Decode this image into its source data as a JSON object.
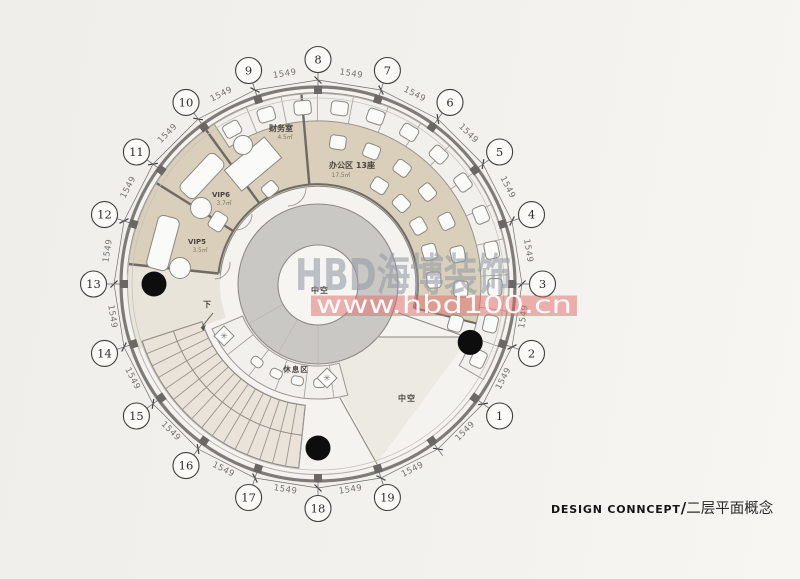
{
  "page": {
    "background": "#f3f1ed"
  },
  "watermark": {
    "brand": "HBD海博装饰",
    "url": "www.hbd100.cn",
    "brand_color": "#949ba6",
    "band_color": "#df6a6a",
    "url_color": "#ffffff"
  },
  "caption": {
    "en": "DESIGN CONNCEPT",
    "divider": "/",
    "cn": "二层平面概念"
  },
  "grid": {
    "dim_label": "1549",
    "bubbles": [
      {
        "n": "1",
        "angle": 324
      },
      {
        "n": "2",
        "angle": 342
      },
      {
        "n": "3",
        "angle": 0
      },
      {
        "n": "4",
        "angle": 18
      },
      {
        "n": "5",
        "angle": 36
      },
      {
        "n": "6",
        "angle": 54
      },
      {
        "n": "7",
        "angle": 72
      },
      {
        "n": "8",
        "angle": 90
      },
      {
        "n": "9",
        "angle": 108
      },
      {
        "n": "10",
        "angle": 126
      },
      {
        "n": "11",
        "angle": 144
      },
      {
        "n": "12",
        "angle": 162
      },
      {
        "n": "13",
        "angle": 180
      },
      {
        "n": "14",
        "angle": 198
      },
      {
        "n": "15",
        "angle": 216
      },
      {
        "n": "16",
        "angle": 234
      },
      {
        "n": "17",
        "angle": 252
      },
      {
        "n": "18",
        "angle": 270
      },
      {
        "n": "19",
        "angle": 288
      }
    ]
  },
  "rooms": [
    {
      "label": "财务室",
      "area": "4.5㎡"
    },
    {
      "label": "办公区  13座",
      "area": "17.5㎡"
    },
    {
      "label": "VIP6",
      "area": "3.7㎡"
    },
    {
      "label": "VIP5",
      "area": "3.5㎡"
    },
    {
      "label": "休息区"
    },
    {
      "label": "中空"
    },
    {
      "label": "中空"
    },
    {
      "label": "下"
    }
  ],
  "plan_colors": {
    "office_fill": "#d9cfbb",
    "ring_fill": "#f2f0ec",
    "walkway_fill": "#e9e4da",
    "stair_fill": "#e9e3d9",
    "wedge_fill": "#edeae4",
    "atrium_ring": "#cac8c5",
    "atrium_hole": "#f6f5f2",
    "interior_fill": "#f5f3f0",
    "wall": "#7f7c78",
    "line": "#8b8781",
    "furniture": "#fafaf8",
    "column_black": "#0d0d0d"
  }
}
